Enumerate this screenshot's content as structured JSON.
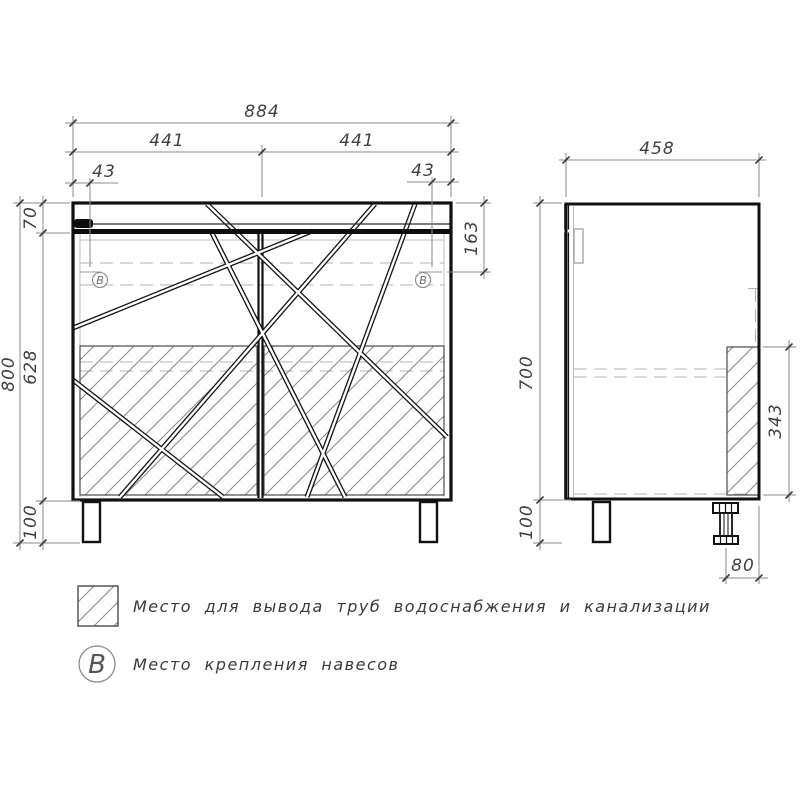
{
  "front_view": {
    "dim_overall_width": "884",
    "dim_left_section": "441",
    "dim_right_section": "441",
    "dim_left_mount_offset": "43",
    "dim_right_mount_offset": "43",
    "dim_top_band_height": "70",
    "dim_body_height": "628",
    "dim_leg_height": "100",
    "dim_total_height": "800",
    "dim_mount_from_top": "163",
    "mount_marker": "В"
  },
  "side_view": {
    "dim_depth": "458",
    "dim_body_height": "700",
    "dim_pipe_zone_height": "343",
    "dim_leg_height": "100",
    "dim_foot_offset": "80"
  },
  "legend": {
    "pipe_zone_label": "Место для вывода труб водоснабжения и канализации",
    "mount_symbol": "В",
    "mount_label": "Место крепления навесов"
  }
}
